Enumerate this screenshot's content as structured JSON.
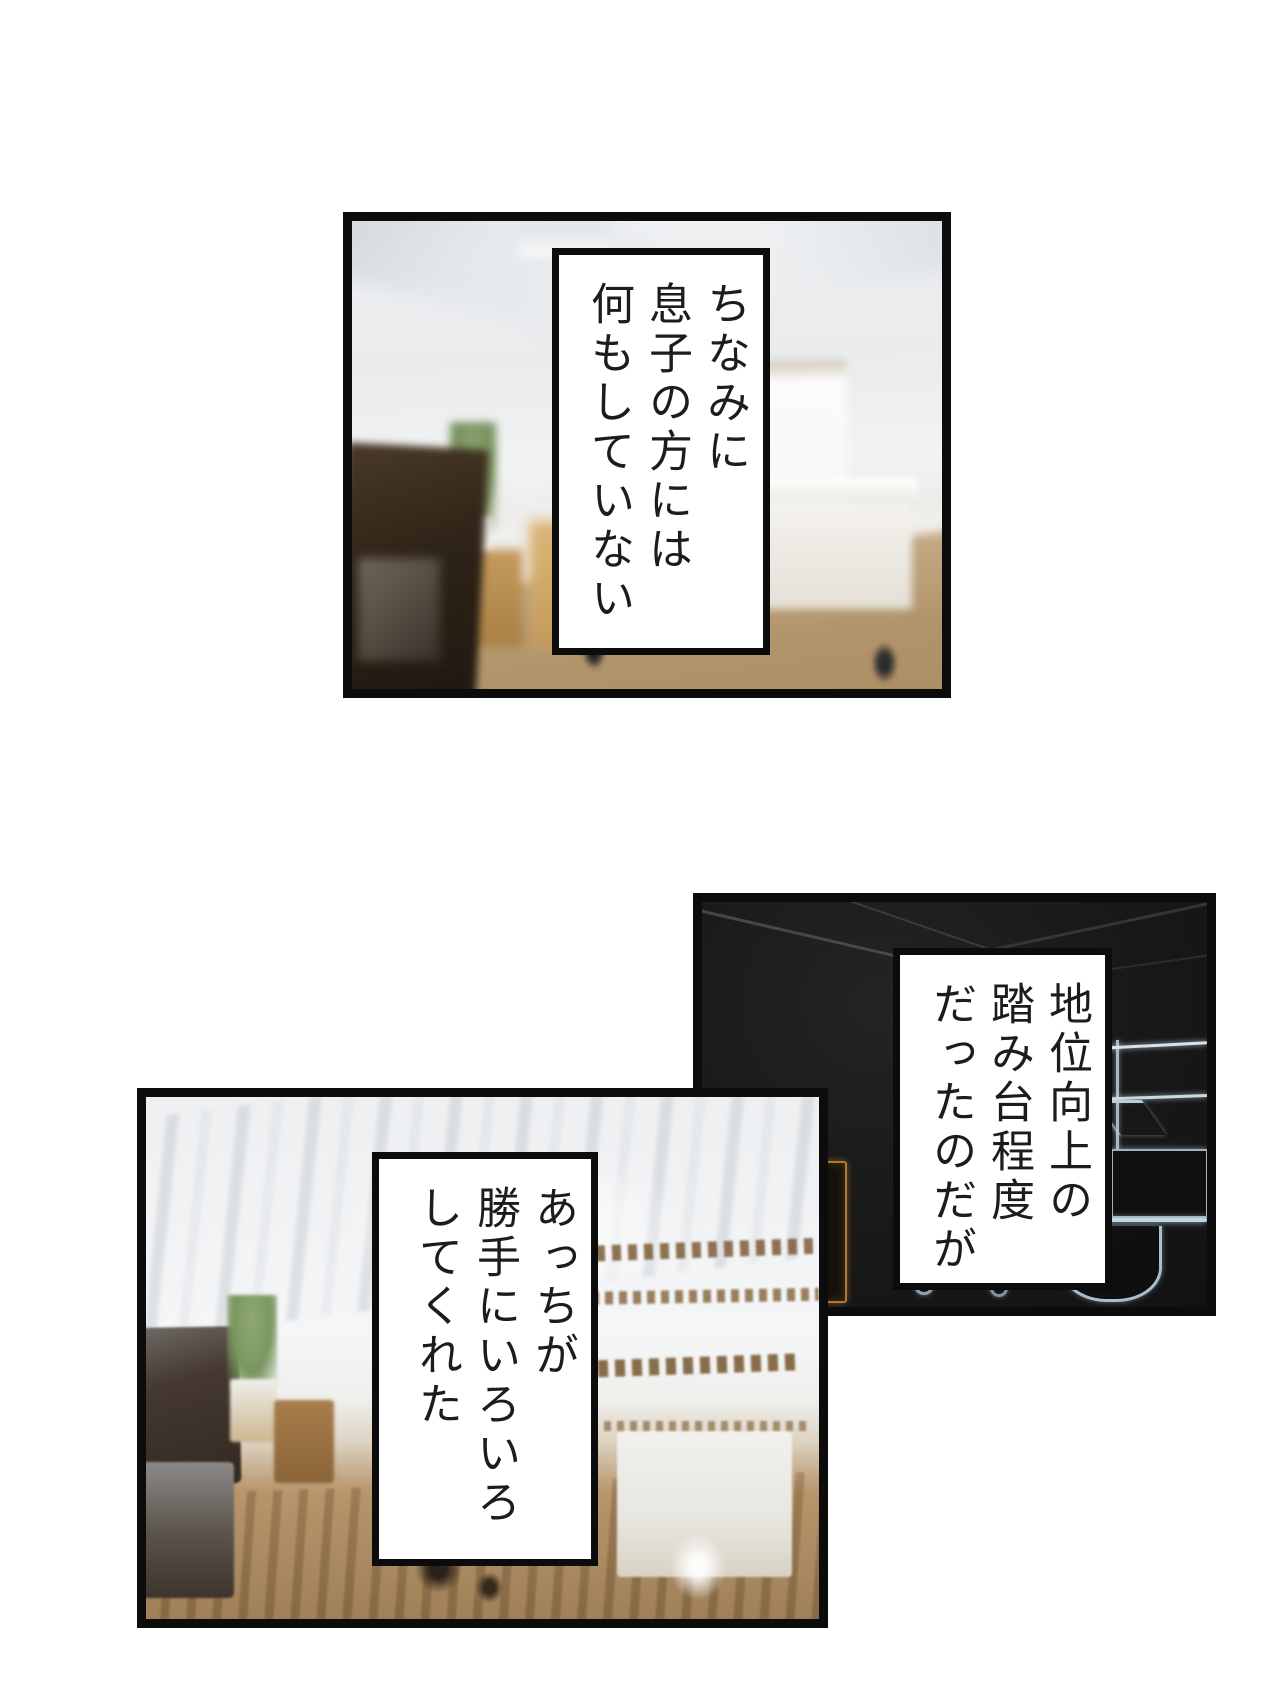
{
  "page": {
    "type": "manga-page",
    "background_color": "#ffffff",
    "panel_border_color": "#0c0c0c",
    "text_color": "#1c1c1c"
  },
  "panels": [
    {
      "name": "top-panel",
      "scene": "blurred bright living room with TV, plant, side table and white desk",
      "dialogue": "ちなみに\n息子の方には\n何もしていない"
    },
    {
      "name": "middle-right-panel",
      "scene": "dark room drawn as glowing neon outlines of shelf, monitor and table",
      "dialogue": "地位向上の\n踏み台程度\nだったのだが"
    },
    {
      "name": "bottom-left-panel",
      "scene": "crystallize-distorted living room with dark cabinet, plant, shelf streaks and white desk",
      "dialogue": "あっちが\n勝手にいろいろ\nしてくれた"
    }
  ]
}
